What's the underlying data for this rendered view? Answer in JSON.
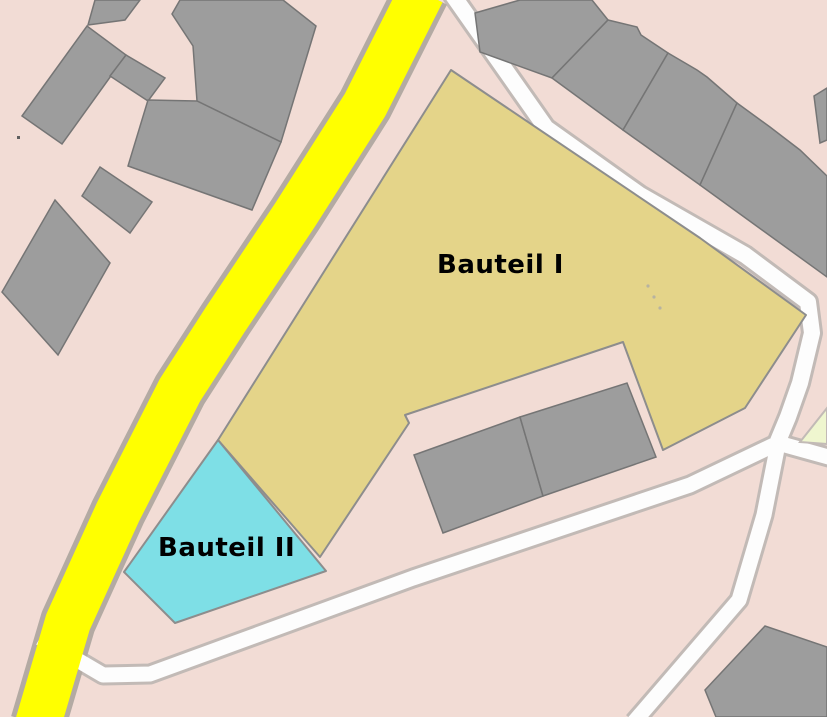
{
  "map": {
    "width": 827,
    "height": 717,
    "background_color": "#f2dcd5",
    "palette": {
      "building_fill": "#9d9d9d",
      "building_stroke": "#757575",
      "area1_fill": "#e4d489",
      "area2_fill": "#7edfe6",
      "area_stroke": "#8d8d8d",
      "road_yellow_fill": "#ffff00",
      "road_yellow_casing": "#b3aaa3",
      "road_white_fill": "#fdfdfd",
      "road_white_casing": "#c2bab6",
      "green_fill": "#eff6cf",
      "label_color": "#000000"
    },
    "labels": [
      {
        "id": "bauteil-1",
        "text": "Bauteil I",
        "x": 437,
        "y": 251,
        "font_size": 26
      },
      {
        "id": "bauteil-2",
        "text": "Bauteil II",
        "x": 158,
        "y": 534,
        "font_size": 26
      }
    ],
    "areas": [
      {
        "name": "bauteil-1-area",
        "fill": "area1_fill",
        "points": [
          [
            451,
            70
          ],
          [
            700,
            238
          ],
          [
            806,
            315
          ],
          [
            745,
            408
          ],
          [
            663,
            450
          ],
          [
            623,
            342
          ],
          [
            405,
            415
          ],
          [
            409,
            423
          ],
          [
            320,
            557
          ],
          [
            218,
            440
          ]
        ]
      },
      {
        "name": "bauteil-2-area",
        "fill": "area2_fill",
        "points": [
          [
            218,
            440
          ],
          [
            326,
            571
          ],
          [
            175,
            623
          ],
          [
            124,
            572
          ]
        ]
      },
      {
        "name": "green-patch",
        "fill": "green_fill",
        "points": [
          [
            800,
            442
          ],
          [
            827,
            408
          ],
          [
            827,
            444
          ]
        ]
      }
    ],
    "roads": [
      {
        "name": "street-northeast",
        "kind": "white",
        "width": 16,
        "casing": 22,
        "points": [
          [
            452,
            -6
          ],
          [
            546,
            128
          ],
          [
            640,
            195
          ],
          [
            745,
            255
          ],
          [
            808,
            302
          ],
          [
            812,
            333
          ],
          [
            800,
            383
          ],
          [
            788,
            417
          ],
          [
            778,
            441
          ]
        ]
      },
      {
        "name": "street-south",
        "kind": "white",
        "width": 15,
        "casing": 21,
        "points": [
          [
            40,
            638
          ],
          [
            103,
            675
          ],
          [
            150,
            674
          ],
          [
            413,
            578
          ],
          [
            690,
            485
          ],
          [
            778,
            443
          ],
          [
            832,
            458
          ]
        ]
      },
      {
        "name": "street-southeast",
        "kind": "white",
        "width": 15,
        "casing": 21,
        "points": [
          [
            778,
            444
          ],
          [
            764,
            515
          ],
          [
            739,
            600
          ],
          [
            634,
            722
          ]
        ]
      },
      {
        "name": "main-road-yellow",
        "kind": "yellow",
        "width": 46,
        "casing": 56,
        "points": [
          [
            422,
            -8
          ],
          [
            365,
            105
          ],
          [
            295,
            215
          ],
          [
            225,
            320
          ],
          [
            180,
            390
          ],
          [
            118,
            512
          ],
          [
            68,
            622
          ],
          [
            38,
            724
          ]
        ]
      }
    ],
    "buildings": [
      {
        "name": "building",
        "points": [
          [
            95,
            0
          ],
          [
            140,
            0
          ],
          [
            125,
            20
          ],
          [
            88,
            25
          ]
        ]
      },
      {
        "name": "building",
        "points": [
          [
            22,
            116
          ],
          [
            87,
            26
          ],
          [
            126,
            55
          ],
          [
            62,
            144
          ]
        ]
      },
      {
        "name": "building",
        "points": [
          [
            126,
            55
          ],
          [
            165,
            78
          ],
          [
            148,
            101
          ],
          [
            110,
            76
          ]
        ]
      },
      {
        "name": "building",
        "points": [
          [
            172,
            14
          ],
          [
            180,
            0
          ],
          [
            283,
            0
          ],
          [
            316,
            26
          ],
          [
            281,
            142
          ],
          [
            197,
            101
          ],
          [
            193,
            46
          ]
        ]
      },
      {
        "name": "building",
        "points": [
          [
            148,
            100
          ],
          [
            197,
            101
          ],
          [
            281,
            142
          ],
          [
            252,
            210
          ],
          [
            128,
            166
          ]
        ]
      },
      {
        "name": "building",
        "points": [
          [
            100,
            167
          ],
          [
            152,
            202
          ],
          [
            130,
            233
          ],
          [
            82,
            196
          ]
        ]
      },
      {
        "name": "building",
        "points": [
          [
            55,
            200
          ],
          [
            110,
            263
          ],
          [
            58,
            355
          ],
          [
            2,
            292
          ]
        ]
      },
      {
        "name": "building",
        "points": [
          [
            475,
            13
          ],
          [
            520,
            0
          ],
          [
            592,
            0
          ],
          [
            608,
            20
          ],
          [
            552,
            78
          ],
          [
            480,
            52
          ]
        ]
      },
      {
        "name": "building",
        "points": [
          [
            608,
            20
          ],
          [
            637,
            27
          ],
          [
            641,
            35
          ],
          [
            668,
            53
          ],
          [
            623,
            130
          ],
          [
            552,
            78
          ]
        ]
      },
      {
        "name": "building",
        "points": [
          [
            668,
            53
          ],
          [
            697,
            70
          ],
          [
            707,
            77
          ],
          [
            737,
            103
          ],
          [
            700,
            185
          ],
          [
            623,
            130
          ]
        ]
      },
      {
        "name": "building",
        "points": [
          [
            737,
            103
          ],
          [
            770,
            127
          ],
          [
            800,
            150
          ],
          [
            827,
            176
          ],
          [
            827,
            277
          ],
          [
            700,
            185
          ]
        ]
      },
      {
        "name": "building",
        "points": [
          [
            814,
            96
          ],
          [
            827,
            88
          ],
          [
            827,
            140
          ],
          [
            820,
            143
          ]
        ]
      },
      {
        "name": "building",
        "points": [
          [
            414,
            455
          ],
          [
            520,
            417
          ],
          [
            543,
            496
          ],
          [
            443,
            533
          ]
        ]
      },
      {
        "name": "building",
        "points": [
          [
            520,
            417
          ],
          [
            627,
            383
          ],
          [
            656,
            457
          ],
          [
            543,
            496
          ]
        ]
      },
      {
        "name": "building",
        "points": [
          [
            705,
            690
          ],
          [
            765,
            626
          ],
          [
            827,
            647
          ],
          [
            827,
            717
          ],
          [
            716,
            717
          ]
        ]
      }
    ],
    "dots": [
      [
        648,
        286
      ],
      [
        654,
        297
      ],
      [
        660,
        308
      ]
    ],
    "small_mark": [
      17,
      136
    ]
  }
}
